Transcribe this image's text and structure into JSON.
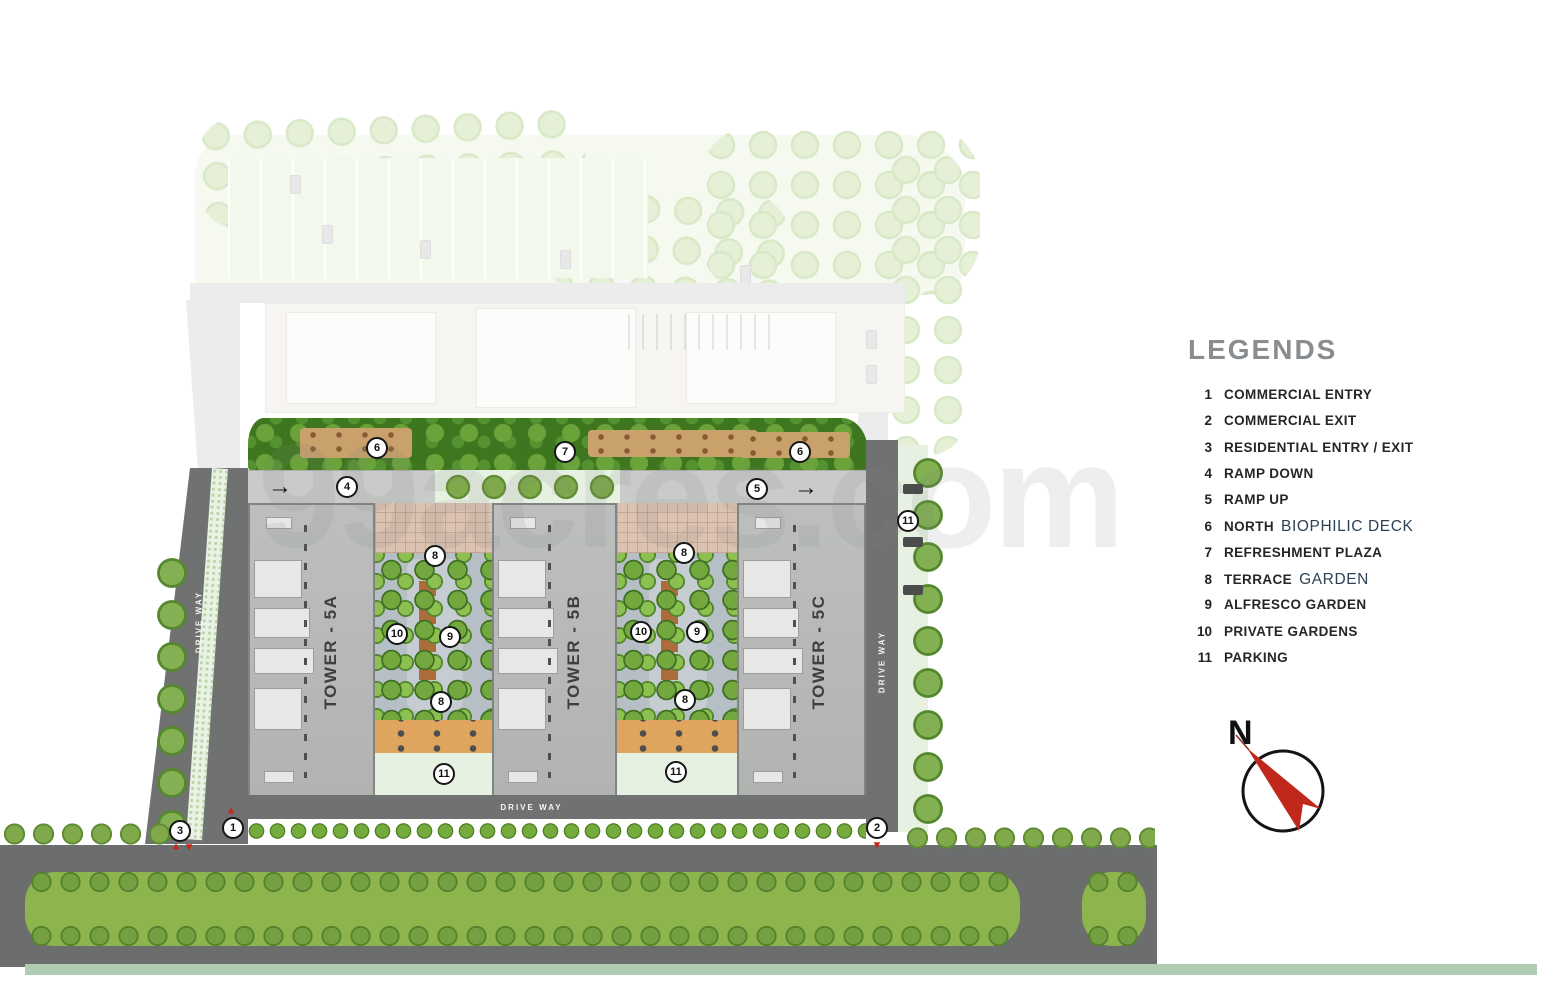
{
  "legends": {
    "title": "LEGENDS",
    "items": [
      {
        "num": "1",
        "label": "COMMERCIAL ENTRY",
        "label_alt": ""
      },
      {
        "num": "2",
        "label": "COMMERCIAL EXIT",
        "label_alt": ""
      },
      {
        "num": "3",
        "label": "RESIDENTIAL ENTRY / EXIT",
        "label_alt": ""
      },
      {
        "num": "4",
        "label": "RAMP DOWN",
        "label_alt": ""
      },
      {
        "num": "5",
        "label": "RAMP UP",
        "label_alt": ""
      },
      {
        "num": "6",
        "label": "NORTH",
        "label_alt": "BIOPHILIC DECK"
      },
      {
        "num": "7",
        "label": "REFRESHMENT PLAZA",
        "label_alt": ""
      },
      {
        "num": "8",
        "label": "TERRACE",
        "label_alt": "GARDEN"
      },
      {
        "num": "9",
        "label": "ALFRESCO GARDEN",
        "label_alt": ""
      },
      {
        "num": "10",
        "label": "PRIVATE GARDENS",
        "label_alt": ""
      },
      {
        "num": "11",
        "label": "PARKING",
        "label_alt": ""
      }
    ]
  },
  "plan": {
    "towers": [
      "TOWER - 5A",
      "TOWER - 5B",
      "TOWER - 5C"
    ],
    "drive_way_label": "DRIVE WAY",
    "watermark": "99acres.com",
    "compass_north": "N",
    "markers": [
      {
        "n": "6",
        "x": 377,
        "y": 448
      },
      {
        "n": "7",
        "x": 565,
        "y": 452
      },
      {
        "n": "6",
        "x": 800,
        "y": 452
      },
      {
        "n": "4",
        "x": 347,
        "y": 487
      },
      {
        "n": "5",
        "x": 757,
        "y": 489
      },
      {
        "n": "8",
        "x": 435,
        "y": 556
      },
      {
        "n": "10",
        "x": 397,
        "y": 634
      },
      {
        "n": "9",
        "x": 450,
        "y": 637
      },
      {
        "n": "8",
        "x": 441,
        "y": 702
      },
      {
        "n": "11",
        "x": 444,
        "y": 774
      },
      {
        "n": "8",
        "x": 684,
        "y": 553
      },
      {
        "n": "10",
        "x": 641,
        "y": 632
      },
      {
        "n": "9",
        "x": 697,
        "y": 632
      },
      {
        "n": "8",
        "x": 685,
        "y": 700
      },
      {
        "n": "11",
        "x": 676,
        "y": 772
      },
      {
        "n": "11",
        "x": 908,
        "y": 521
      },
      {
        "n": "3",
        "x": 180,
        "y": 831
      },
      {
        "n": "1",
        "x": 233,
        "y": 828
      },
      {
        "n": "2",
        "x": 877,
        "y": 828
      }
    ],
    "arrows": [
      {
        "x": 280,
        "y": 487
      },
      {
        "x": 806,
        "y": 488
      }
    ],
    "triangles": [
      {
        "x": 231,
        "y": 811,
        "dir": "up"
      },
      {
        "x": 176,
        "y": 847,
        "dir": "up"
      },
      {
        "x": 189,
        "y": 848,
        "dir": "down"
      },
      {
        "x": 877,
        "y": 846,
        "dir": "down"
      }
    ],
    "colors": {
      "accent_red": "#c9251a",
      "road_gray": "#6b6e6c",
      "median_green": "#8db44d",
      "deck_green": "#3e761f",
      "legend_title_gray": "#8a8d90",
      "legend_alt_blue": "#2e4257"
    }
  }
}
